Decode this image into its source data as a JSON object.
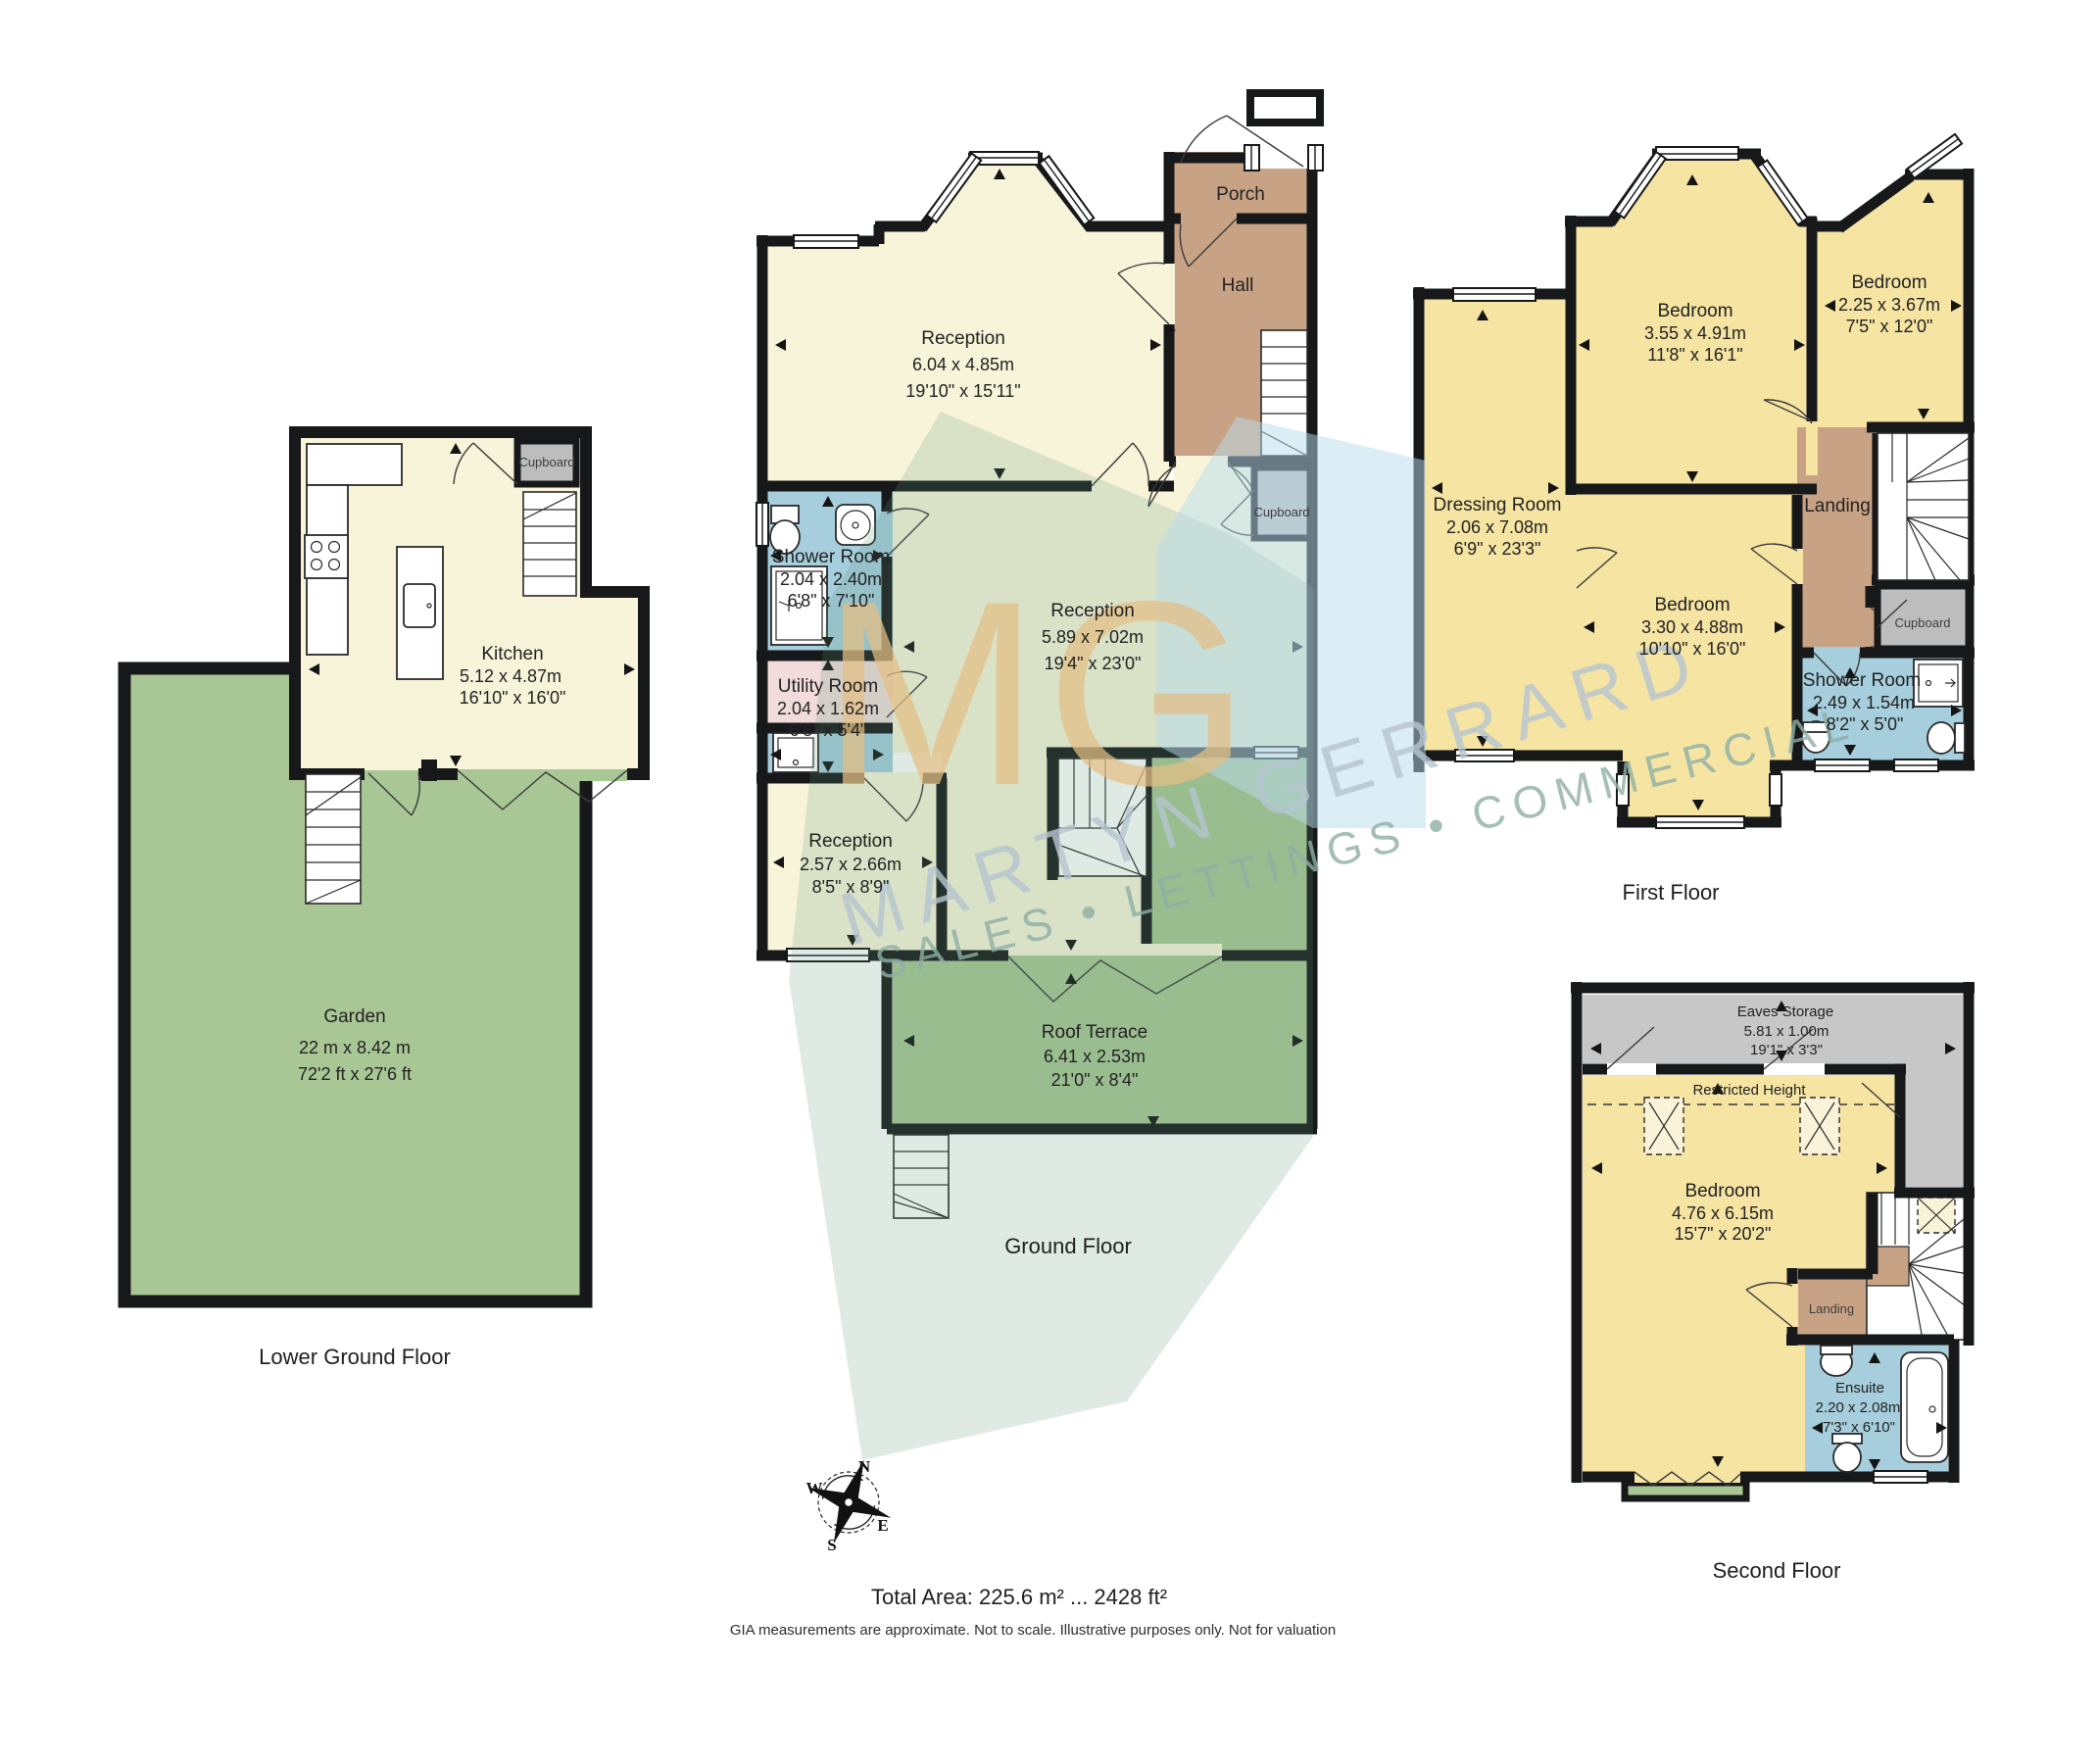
{
  "watermark": {
    "monogram": "MG",
    "brand": "MARTYN GERRARD",
    "tagline": "SALES • LETTINGS • COMMERCIAL"
  },
  "compass": {
    "north": "N",
    "west": "W",
    "east": "E",
    "south": "S"
  },
  "floors": {
    "lgf": {
      "label": "Lower Ground Floor",
      "kitchen": {
        "name": "Kitchen",
        "metric": "5.12 x 4.87m",
        "imperial": "16'10\" x 16'0\""
      },
      "cupboard": {
        "name": "Cupboard"
      },
      "garden": {
        "name": "Garden",
        "metric": "22 m x 8.42 m",
        "imperial": "72'2 ft x 27'6 ft"
      }
    },
    "gf": {
      "label": "Ground Floor",
      "porch": {
        "name": "Porch"
      },
      "hall": {
        "name": "Hall"
      },
      "reception_front": {
        "name": "Reception",
        "metric": "6.04 x 4.85m",
        "imperial": "19'10\" x 15'11\""
      },
      "shower": {
        "name": "Shower Room",
        "metric": "2.04 x 2.40m",
        "imperial": "6'8\" x 7'10\""
      },
      "utility": {
        "name": "Utility Room",
        "metric": "2.04 x 1.62m",
        "imperial": "6'8\" x 5'4\""
      },
      "reception_main": {
        "name": "Reception",
        "metric": "5.89 x 7.02m",
        "imperial": "19'4\" x 23'0\""
      },
      "cupboard": {
        "name": "Cupboard"
      },
      "reception_rear": {
        "name": "Reception",
        "metric": "2.57 x 2.66m",
        "imperial": "8'5\" x 8'9\""
      },
      "terrace": {
        "name": "Roof Terrace",
        "metric": "6.41 x 2.53m",
        "imperial": "21'0\" x 8'4\""
      }
    },
    "ff": {
      "label": "First Floor",
      "bedroom_front": {
        "name": "Bedroom",
        "metric": "3.55 x 4.91m",
        "imperial": "11'8\" x 16'1\""
      },
      "bedroom_side": {
        "name": "Bedroom",
        "metric": "2.25 x 3.67m",
        "imperial": "7'5\" x 12'0\""
      },
      "dressing": {
        "name": "Dressing Room",
        "metric": "2.06 x 7.08m",
        "imperial": "6'9\" x 23'3\""
      },
      "landing": {
        "name": "Landing"
      },
      "bedroom_rear": {
        "name": "Bedroom",
        "metric": "3.30 x 4.88m",
        "imperial": "10'10\" x 16'0\""
      },
      "cupboard": {
        "name": "Cupboard"
      },
      "shower": {
        "name": "Shower Room",
        "metric": "2.49 x 1.54m",
        "imperial": "8'2\" x 5'0\""
      }
    },
    "sf": {
      "label": "Second Floor",
      "eaves": {
        "name": "Eaves Storage",
        "metric": "5.81 x 1.00m",
        "imperial": "19'1\" x 3'3\""
      },
      "restricted": {
        "name": "Restricted Height"
      },
      "bedroom": {
        "name": "Bedroom",
        "metric": "4.76 x 6.15m",
        "imperial": "15'7\" x 20'2\""
      },
      "landing": {
        "name": "Landing"
      },
      "ensuite": {
        "name": "Ensuite",
        "metric": "2.20 x 2.08m",
        "imperial": "7'3\" x 6'10\""
      }
    }
  },
  "footer": {
    "total_area": "Total Area: 225.6 m² ... 2428 ft²",
    "disclaimer": "GIA measurements are approximate. Not to scale. Illustrative purposes only. Not for valuation"
  },
  "palette": {
    "wall": "#17181a",
    "room_cream": "#f8f4da",
    "room_yellow": "#f6e4a3",
    "garden_green": "#a9c795",
    "hall_brown": "#c8a284",
    "bath_blue": "#a6cedc",
    "utility_pink": "#f2dcdb",
    "cupboard_gray": "#bdbdbd",
    "eaves_gray": "#c7c7c7"
  }
}
